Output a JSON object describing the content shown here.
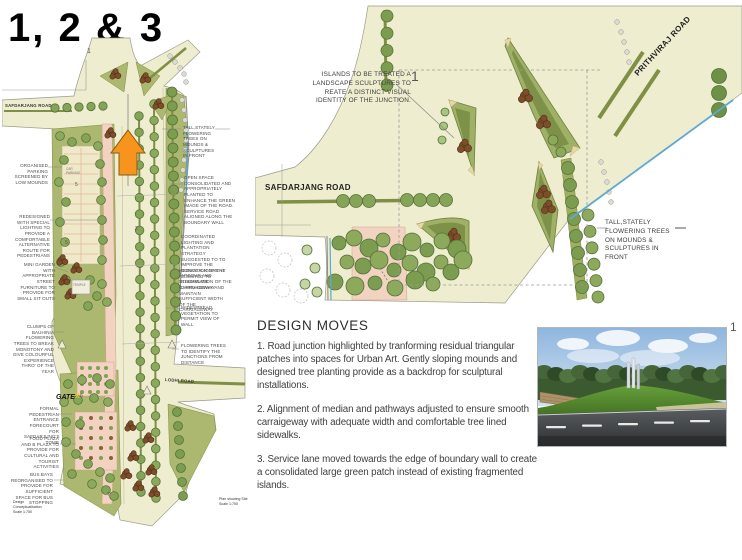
{
  "page": {
    "title": "1, 2 & 3"
  },
  "colors": {
    "plan_base": "#EFEDCF",
    "green_patch": "#ACB86F",
    "tree_green": "#86A458",
    "clump_brown": "#7D4E29",
    "path_pink": "#F2D3C2",
    "median_olive": "#7F8F45",
    "water_blue": "#5FA8D0",
    "arrow_orange": "#F7941D",
    "annotation_gray": "#4b4b4b"
  },
  "master_plan": {
    "marker": "1",
    "labels": {
      "safdarjang": "SAFDARJANG ROAD",
      "lodhi": "LODHI ROAD",
      "gate": "GATE",
      "gate_x": "X",
      "temple": "TEMPLE",
      "car_parking": "CAR PARKING"
    },
    "numbers": [
      "5",
      "5",
      "2",
      "6",
      "7"
    ],
    "left_annotations": [
      "ORGANISED PARKING SCREENED BY LOW MOUNDS",
      "REDESIGNED WITH SPECIAL LIGHTING TO PROVIDE A COMFORTABLE ALTERNATIVE ROUTE FOR PEDESTRIANS",
      "MINI GARDEN WITH APPROPRIATE STREET FURNITURE TO PROVIDE FOR SMALL SIT OUTS",
      "CLUMPS OF BAUHINIA FLOWERING TREES TO BREAK MONOTONY AND GIVE COLOURFUL EXPERIENCE THRO' OF THE YEAR",
      "FORMAL PEDESTRIAN ENTRANCE FORECOURT FOR SAFDARJUNG'S TOMB",
      "FOOD PLAZA AND B PLAZA TO PROVIDE FOR CULTURAL AND TOURIST ACTIVITIES",
      "BUS BAYS REORGANISED TO PROVIDE FOR SUFFICIENT SPACE FOR BUS STOPPING"
    ],
    "right_annotations": [
      "TALL,STATELY FLOWERING TREES ON MOUNDS & SCULPTURES IN FRONT",
      "OPEN SPACE CONSOLIDATED AND APPROPRIATELY PLANTED TO ENHANCE THE GREEN IMAGE OF THE ROAD. SERVICE ROAD ALIGNED ALONG THE BOUNDARY WALL",
      "COORDINATED LIGHTING AND PLANTATION STRATEGY SUGGESTED TO TO IMPROVE THE CONDITION OF THE ARBOUR AND ILLUMINATION OF THE CARRIAGEWAY",
      "MEDIAN ALIGNMENT ADJUSTED TO STREAMLINE CARRIAGEWAY AND MAINTAIN SUFFICIENT WIDTH OF THE CARRIAGEWAY",
      "WIDESPREAD VEGETATION TO PERMIT VIEW OF WALL",
      "FLOWERING TREES TO IDENTIFY THE JUNCTIONS FROM DISTANCE"
    ],
    "caption_left": [
      "Design Conceptualisation",
      "Scale 1:750"
    ],
    "caption_right": [
      "Plan showing Site",
      "Scale 1:750"
    ]
  },
  "junction_plan": {
    "marker": "1",
    "annotation_islands": "ISLANDS TO BE TREATED A LANDSCAPE SCULPTURES TO REATE A DISTINCT VISUAL IDENTITY OF THE JUNCTION.",
    "annotation_trees": "TALL,STATELY FLOWERING TREES ON MOUNDS & SCULPTURES IN FRONT",
    "road_safdarjang": "SAFDARJANG ROAD",
    "road_prithviraj": "PRITHVIRAJ ROAD"
  },
  "design_moves": {
    "title": "DESIGN MOVES",
    "items": [
      "1. Road junction highlighted by tranforming residual triangular patches into spaces for Urban Art. Gently sloping mounds and designed tree planting provide as a backdrop for sculptural installations.",
      "2. Alignment of median and pathways adjusted to ensure smooth carraigeway with adequate width and comfortable tree lined sidewalks.",
      "3. Service lane moved towards the edge of boundary wall to create a consolidated large green patch instead of existing fragmented islands."
    ]
  },
  "photo": {
    "figure_number": "1"
  }
}
